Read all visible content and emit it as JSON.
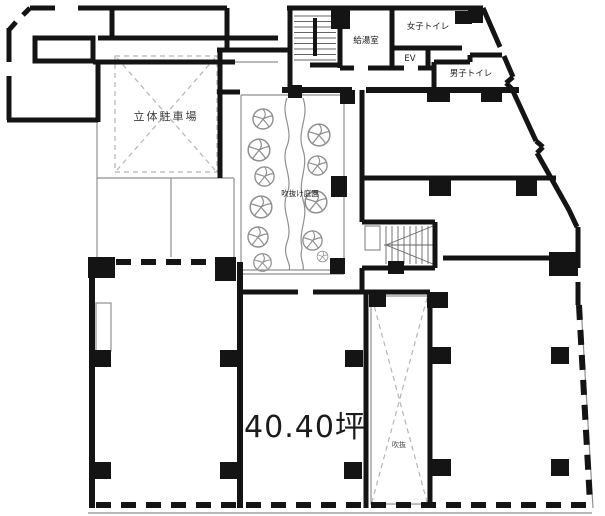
{
  "floorplan": {
    "labels": {
      "parking": "立体駐車場",
      "kitchenette": "給湯室",
      "womens_toilet": "女子トイレ",
      "elevator": "EV",
      "mens_toilet": "男子トイレ",
      "atrium_garden": "吹抜け庭園",
      "area": "40.40坪",
      "void": "吹抜"
    },
    "colors": {
      "background": "#ffffff",
      "wall": "#141414",
      "thin_line": "#8f8f8f",
      "dashed_detail": "#b5b5b5",
      "text": "#1a1a1a"
    }
  }
}
